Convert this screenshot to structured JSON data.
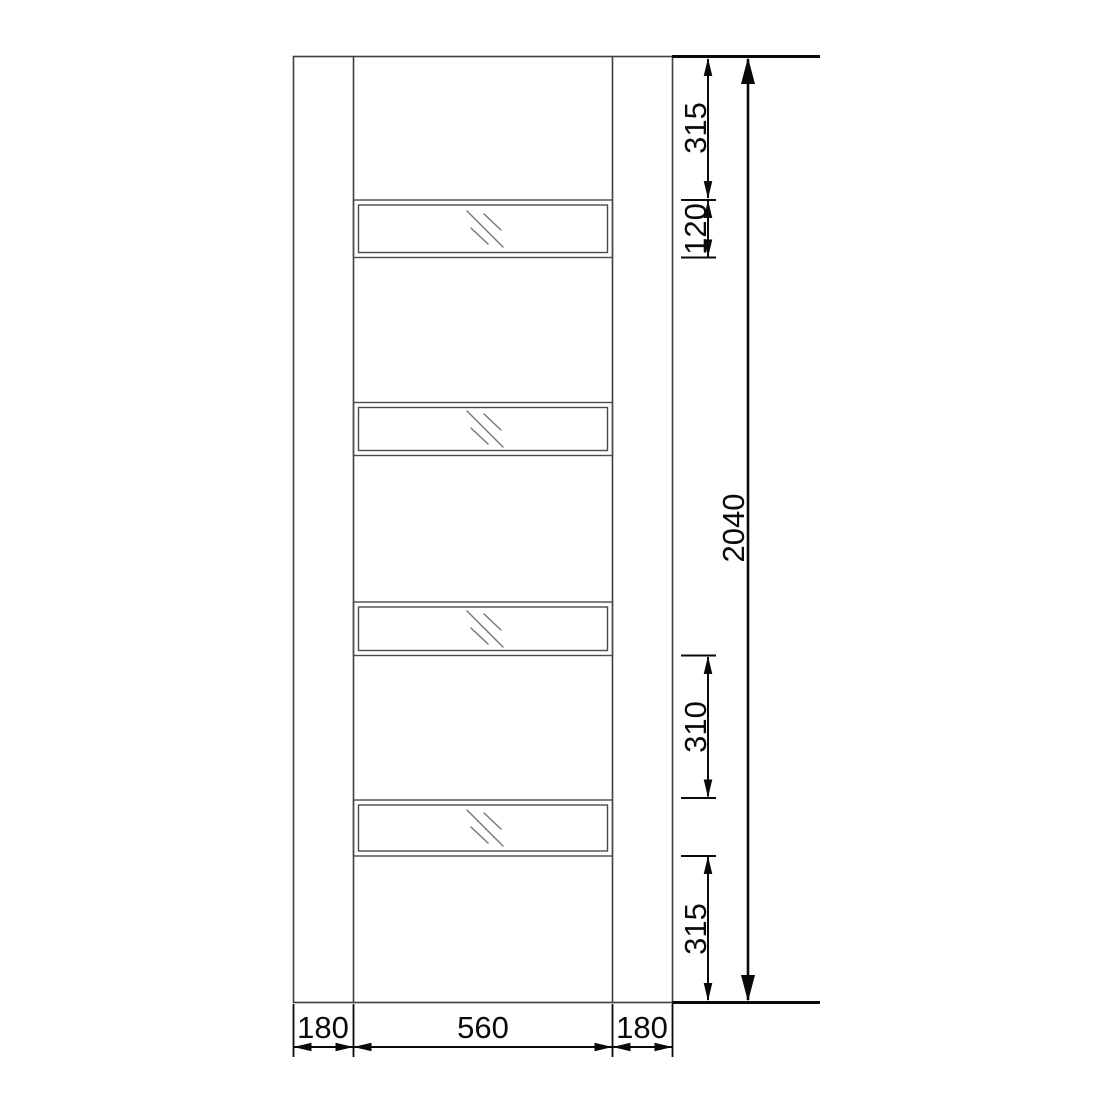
{
  "diagram": {
    "type": "door-elevation-technical-drawing",
    "units": "mm",
    "door": {
      "overall_height": "2040",
      "overall_width_segments": [
        "180",
        "560",
        "180"
      ],
      "glass_panel_count": 4
    },
    "right_dimensions": {
      "top_offset": "315",
      "panel_height": "120",
      "overall_height": "2040",
      "panel_gap": "310",
      "bottom_offset": "315"
    },
    "bottom_dimensions": {
      "left_stile_width": "180",
      "glazing_width": "560",
      "right_stile_width": "180"
    },
    "colors": {
      "outline": "#3f3f3f",
      "panel-line": "#4a4a4a",
      "glass-mark": "#7a7a7a",
      "dimension": "#0a0a0a",
      "background": "#ffffff"
    }
  }
}
